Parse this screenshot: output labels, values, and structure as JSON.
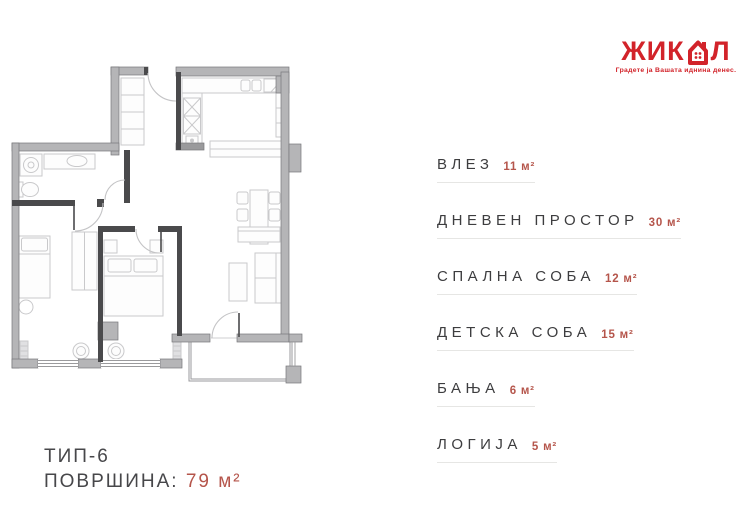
{
  "logo": {
    "name_start": "ЖИК",
    "name_end": "Л",
    "tagline": "Градете ја Вашата иднина денес.",
    "color": "#d2232a"
  },
  "legend": {
    "items": [
      {
        "label": "ВЛЕЗ",
        "area": "11 м²"
      },
      {
        "label": "ДНЕВЕН ПРОСТОР",
        "area": "30 м²"
      },
      {
        "label": "СПАЛНА СОБА",
        "area": "12 м²"
      },
      {
        "label": "ДЕТСКА СОБА",
        "area": "15 м²"
      },
      {
        "label": "БАЊА",
        "area": "6 м²"
      },
      {
        "label": "ЛОГИЈА",
        "area": "5 м²"
      }
    ]
  },
  "summary": {
    "type": "ТИП-6",
    "area_label": "ПОВРШИНА:",
    "area_value": "79 м²"
  },
  "colors": {
    "accent_red": "#d2232a",
    "area_red": "#b5554b",
    "text_dark": "#3d3d3f",
    "wall_gray": "#b5b5b7",
    "wall_dark": "#4a4a4c",
    "furniture_gray": "#c6c6c8"
  }
}
